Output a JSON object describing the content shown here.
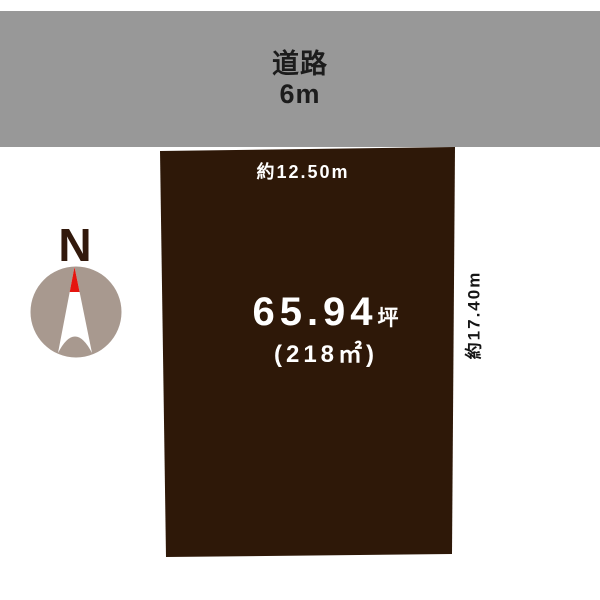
{
  "road": {
    "label": "道路",
    "width_label": "6m",
    "fill_color": "#989898",
    "text_color": "#1c1c1c"
  },
  "plot": {
    "fill_color": "#2e1808",
    "top_dimension": "約12.50m",
    "right_dimension": "約17.40m",
    "area_tsubo_value": "65.94",
    "area_tsubo_unit": "坪",
    "area_sqm": "(218㎡)",
    "area_text_color": "#ffffff",
    "dimension_text_color": "#151515"
  },
  "compass": {
    "label": "N",
    "label_color": "#32190c",
    "circle_color": "#a8998f",
    "needle_color": "#ffffff",
    "needle_tip_color": "#e5150f"
  }
}
